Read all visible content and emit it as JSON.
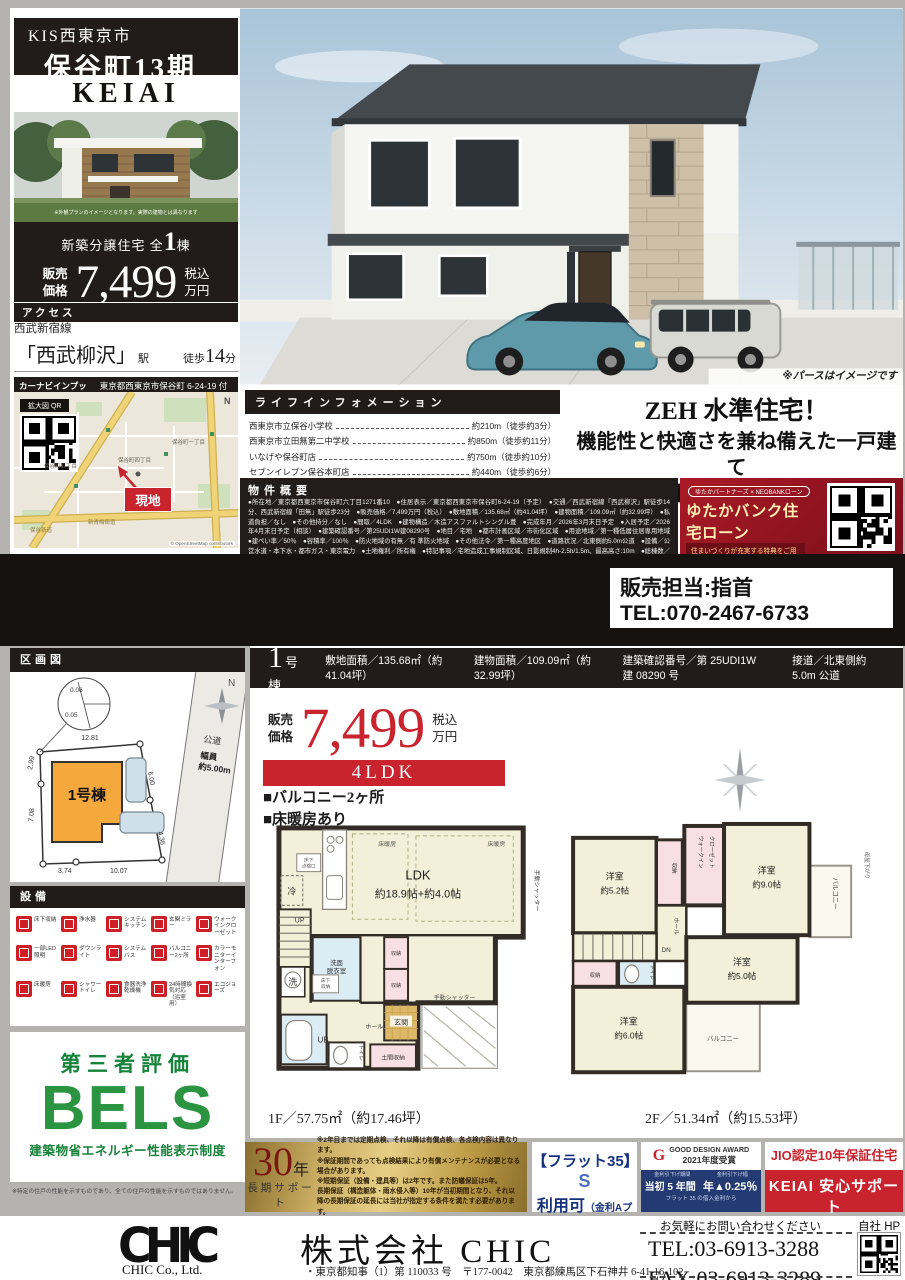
{
  "colors": {
    "accent_red": "#c9232d",
    "dark_bar": "#211c19",
    "loan_red": "#8e1320",
    "gold": "#cdb065",
    "bels_green": "#2a9440",
    "navy": "#233a72"
  },
  "header": {
    "tag": "KIS西東京市",
    "project": "保谷町13期",
    "brand": "KEIAI GRACE",
    "photo_caption": "※外観プランのイメージとなります。実際の建物とは異なります"
  },
  "price_box": {
    "lead": "新築分譲住宅 全",
    "count": "1",
    "count_unit": "棟",
    "sale1": "販売",
    "sale2": "価格",
    "price": "7,499",
    "tax1": "税込",
    "tax2": "万円"
  },
  "access": {
    "title": "アクセス",
    "line": "西武新宿線",
    "stations": [
      {
        "name": "「西武柳沢」",
        "unit": "駅",
        "walk": "徒歩",
        "min": "14",
        "sfx": "分"
      },
      {
        "name": "「田無」",
        "unit": "駅",
        "walk": "徒歩",
        "min": "23",
        "sfx": "分"
      }
    ],
    "carnav_label": "カーナビインプット",
    "carnav_address": "東京都西東京市保谷町 6-24-19 付近"
  },
  "map": {
    "qr_label": "拡大図 QR",
    "site": "現地",
    "credit": "© OpenStreetMap contributors",
    "towns": [
      "保谷町五丁目",
      "保谷町四丁目",
      "保谷町一丁目"
    ],
    "roads": [
      "新青梅街道",
      "保谷新道"
    ],
    "north": "N"
  },
  "main_visual": {
    "caption": "※パースはイメージです"
  },
  "life_info": {
    "title": "ライフインフォメーション",
    "items": [
      {
        "name": "西東京市立保谷小学校",
        "dist": "約210m（徒歩約3分）"
      },
      {
        "name": "西東京市立田無第二中学校",
        "dist": "約850m（徒歩約11分）"
      },
      {
        "name": "いなげや保谷町店",
        "dist": "約750m（徒歩約10分）"
      },
      {
        "name": "セブンイレブン保谷本町店",
        "dist": "約440m（徒歩約6分）"
      },
      {
        "name": "ドラッグセイムス西東京保谷薬局店",
        "dist": "約320m（徒歩約4分）"
      }
    ]
  },
  "catch_copy": {
    "lines": [
      "ZEH 水準住宅！",
      "機能性と快適さを兼ね備えた一戸建て",
      "収納豊富な間取りは子育て世帯に優しい住まい"
    ]
  },
  "overview": {
    "title": "物件概要",
    "body": "●所在地／東京都西東京市保谷町六丁目1271番10　●住居表示／東京都西東京市保谷町6-24-19（予定）　●交通／西武新宿線「西武柳沢」駅徒歩14分、西武新宿線「田無」駅徒歩23分　●販売価格／7,499万円（税込）　●敷地面積／135.68㎡（約41.04坪）　●建物面積／109.09㎡（約32.99坪）　●私道負担／なし　●その他持分／なし　●間取／4LDK　●建物構造／木造アスファルトシングル葺　●完成年月／2026年3月末日予定　●入居予定／2026年4月末日予定（相談）　●建築確認番号／第25UDI1W建08290号　●地目／宅地　●都市計画区域／市街化区域　●用途地域／第一種低層住居専用地域　●建ぺい率／50％　●容積率／100％　●防火地域の有無／有 準防火地域　●その他法令／第一種高度地区　●道路状況／北東側約5.0m公道　●設備／公営水道・本下水・都市ガス・東京電力　●土地権利／所有権　●特記事項／宅地造成工事規制区域、日影規制4h-2.5h/1.5m、最高高さ:10m　●総棟数／1棟",
    "notes": "※網戸、カーテンレール、TVアンテナはオプションとなります。　※電波障害によるケーブルテレビ、共聴アンテナ申込みはお客様負担となります。　※司法書士・土地家屋調査士は当社指定となります。建物表示登記費用:102,000円（税込）　※税込とは消費税込のことです。　※広告作成中に売約になる場合がございます。　※図面と現況が異なる場合は現況を優先とさせて頂きます。"
  },
  "loan": {
    "partners": "ゆたかパートナーズ × NEOBANKローン",
    "title": "ゆたかバンク住宅ローン",
    "subtitle": "住まいづくりが充実する特典をご用意！",
    "point_label": "KEIAIポイント",
    "point_prefix": "最大",
    "point_num": "25",
    "point_sfx1": "万ポイント",
    "point_sfx2": "プレゼント",
    "opt_label": "オプション工事",
    "opt_num": "5",
    "opt_sfx": "％割引"
  },
  "contact": {
    "person": "販売担当:指首",
    "tel": "TEL:070-2467-6733"
  },
  "lot_plan": {
    "title": "区画図",
    "building": "1号棟",
    "road": "公道",
    "width1": "幅員",
    "width2": "約5.00m",
    "north": "N",
    "d_top": "12.81",
    "d_l1": "2.99",
    "d_l2": "7.08",
    "d_b1": "3.74",
    "d_b2": "10.07",
    "d_r1": "6.00",
    "d_r2": "4.36",
    "d_c1": "0.06",
    "d_c2": "0.05"
  },
  "equipment": {
    "title": "設備",
    "items": [
      "床下収納",
      "浄水器",
      "システムキッチン",
      "玄関ミラー",
      "ウォークインクローゼット",
      "一部LED照明",
      "ダウンライト",
      "システムバス",
      "バルコニー2ヶ所",
      "カラーモニターインターフォン",
      "床暖房",
      "シャワートイレ",
      "食器洗浄乾燥機",
      "24時間換気対応（浴室用）",
      "エコジョーズ"
    ]
  },
  "bels": {
    "heading": "第三者評価",
    "logo": "BELS",
    "subtitle": "建築物省エネルギー性能表示制度",
    "note": "※特定の住戸の性能を示すものであり、全ての住戸の性能を示すものではありません。"
  },
  "unit": {
    "num": "1",
    "num_unit": "号棟",
    "specs": [
      "敷地面積／135.68㎡（約41.04坪）",
      "建物面積／109.09㎡（約32.99坪）",
      "建築確認番号／第 25UDI1W 建 08290 号",
      "接道／北東側約 5.0m 公道"
    ],
    "sale1": "販売",
    "sale2": "価格",
    "price": "7,499",
    "tax1": "税込",
    "tax2": "万円",
    "layout": "4LDK",
    "features": [
      "■バルコニー2ヶ所",
      "■床暖房あり"
    ]
  },
  "plan1f": {
    "caption": "1F／57.75㎡（約17.46坪）",
    "ldk": "LDK",
    "ldk_size": "約18.9帖+約4.0帖",
    "yuka": "床暖房",
    "rei": "冷",
    "tenken1": "床下",
    "tenken2": "点検口",
    "up": "UP",
    "senmen1": "洗面",
    "senmen2": "脱衣室",
    "yukashita1": "床下",
    "yukashita2": "収納",
    "sen": "洗",
    "ub": "UB",
    "toilet": "トイレ",
    "hall": "ホール",
    "genkan": "玄関",
    "doma": "土間収納",
    "shuno": "収納",
    "shutter": "手動シャッター"
  },
  "plan2f": {
    "caption": "2F／51.34㎡（約15.53坪）",
    "yoshitsu": "洋室",
    "s52": "約5.2帖",
    "s90": "約9.0帖",
    "s50": "約5.0帖",
    "s60": "約6.0帖",
    "wic1": "ウォークイン",
    "wic2": "クローゼット",
    "shuno": "収納",
    "toilet": "トイレ",
    "dn": "DN",
    "hall": "ホール",
    "balcony": "バルコニー",
    "moya": "母屋下がり"
  },
  "support": {
    "thirty": {
      "num": "30",
      "unit": "年",
      "label": "長期サポート",
      "notes": [
        "※2年目までは定期点検、それ以降は有償点検、各点検内容は異なります。",
        "※保証期間であっても点検結果により有償メンテナンスが必要となる場合があります。",
        "※短期保証（設備・建具等）は2年です。また防蟻保証は5年。",
        "長期保証（構造躯体・雨水侵入等）10年が当初期間となり、それ以降の長期保証の延長には当社が指定する条件を満たす必要があります。"
      ]
    },
    "flat35": {
      "t1": "【フラット35】",
      "t2": "S",
      "avail": "利用可",
      "plan": "（金利Aプラン）",
      "note": "お申込時手数料がかかります"
    },
    "gd": {
      "award": "GOOD DESIGN AWARD",
      "year": "2021年度受賞",
      "tag1": "金利引下げ期間",
      "tag2": "金利引下げ幅",
      "term": "当初 5 年間",
      "rate": "年▲0.25％",
      "note": "フラット 35 の借入金利から"
    },
    "jio": "JIO認定10年保証住宅",
    "keiai": {
      "title": "KEIAI 安心サポート",
      "note": "別途保証料がかかります"
    }
  },
  "footer": {
    "logo": "CHIC",
    "company_en": "CHIC Co., Ltd.",
    "company": "株式会社 CHIC",
    "license": "・東京都知事（1）第 110033 号　〒177-0042　東京都練馬区下石神井 6-41-16-102",
    "lead": "お気軽にお問い合わせください",
    "tel": "TEL:03-6913-3288",
    "fax": "FAX:03-6913-3289",
    "hp": "自社 HP"
  }
}
